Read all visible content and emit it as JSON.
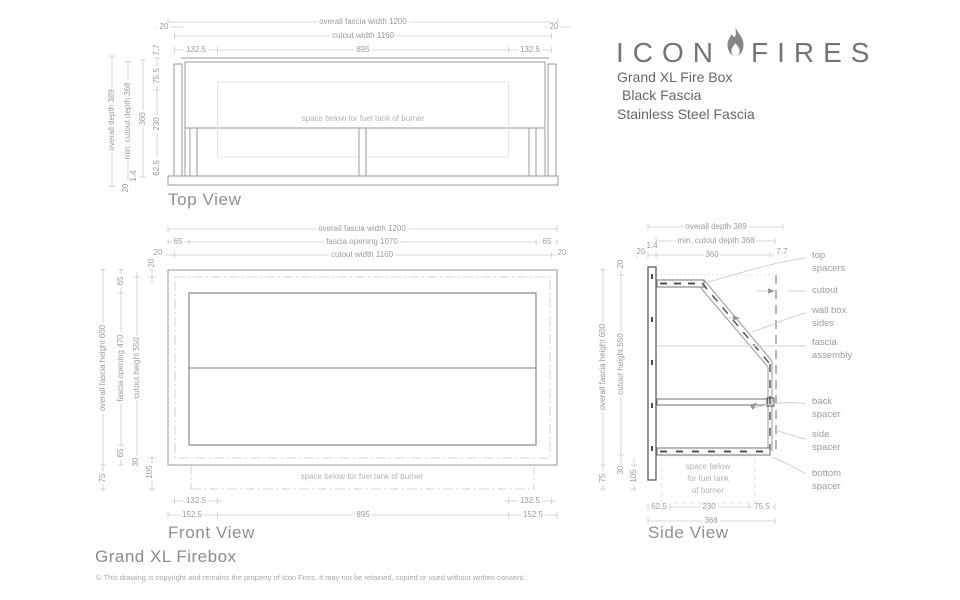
{
  "header": {
    "logo_word_left": "ICON",
    "logo_word_right": "FIRES",
    "product_lines": {
      "line1": "Grand XL Fire Box",
      "line2": "Black Fascia",
      "line3": "Stainless Steel Fascia"
    }
  },
  "top_view": {
    "title": "Top View",
    "note": "space below for fuel tank of burner",
    "dims": {
      "overall_fascia_width": "overall fascia width 1200",
      "cutout_width": "cutout width 1160",
      "edge_20": "20",
      "seg_132_5": "132.5",
      "seg_895": "895",
      "overall_depth": "overall depth 389",
      "min_cutout_depth": "min. cutout depth 368",
      "depth_360": "360",
      "d7_7": "7.7",
      "d75_5": "75.5",
      "d230": "230",
      "d62_5": "62.5",
      "d1_4": "1.4",
      "d20": "20"
    }
  },
  "front_view": {
    "title": "Front View",
    "note": "space below for fuel tank of burner",
    "dims": {
      "overall_fascia_width": "overall fascia width 1200",
      "fascia_opening_w": "fascia opening 1070",
      "cutout_width": "cutout width 1160",
      "d65": "65",
      "d20": "20",
      "overall_fascia_height": "overall fascia height 600",
      "fascia_opening_h": "fascia opening 470",
      "cutout_height": "cutout height 550",
      "d30": "30",
      "d105": "105",
      "d75": "75",
      "seg_132_5": "132.5",
      "seg_152_5": "152.5",
      "seg_895": "895"
    }
  },
  "side_view": {
    "title": "Side View",
    "note": "space below\nfor fuel tank\nof burner",
    "dims": {
      "overall_depth": "overall depth 389",
      "min_cutout_depth": "min. cutout depth 368",
      "d20": "20",
      "d1_4": "1.4",
      "d360": "360",
      "d7_7": "7.7",
      "overall_fascia_height": "overall fascia height 600",
      "cutout_height": "cutout height 550",
      "top_20": "20",
      "d75": "75",
      "d30": "30",
      "d105": "105",
      "seg_62_5": "62.5",
      "seg_230": "230",
      "seg_75_5": "75.5",
      "seg_368": "368"
    },
    "callouts": {
      "top_spacers": "top\nspacers",
      "cutout": "cutout",
      "wall_box_sides": "wall box\nsides",
      "fascia_assembly": "fascia\nassembly",
      "back_spacer": "back\nspacer",
      "side_spacer": "side\nspacer",
      "bottom_spacer": "bottom\nspacer"
    }
  },
  "footer": {
    "title": "Grand XL Firebox",
    "copyright": "© This drawing is copyright and remains the property of Icon Fires. It may not be retained, copied or used without written consent."
  },
  "colors": {
    "dim_line": "#cbcbcb",
    "outline": "#9a9a9a",
    "dark_line": "#4f4f4f",
    "label_text": "#9b9b9b",
    "logo_gray": "#737478"
  }
}
